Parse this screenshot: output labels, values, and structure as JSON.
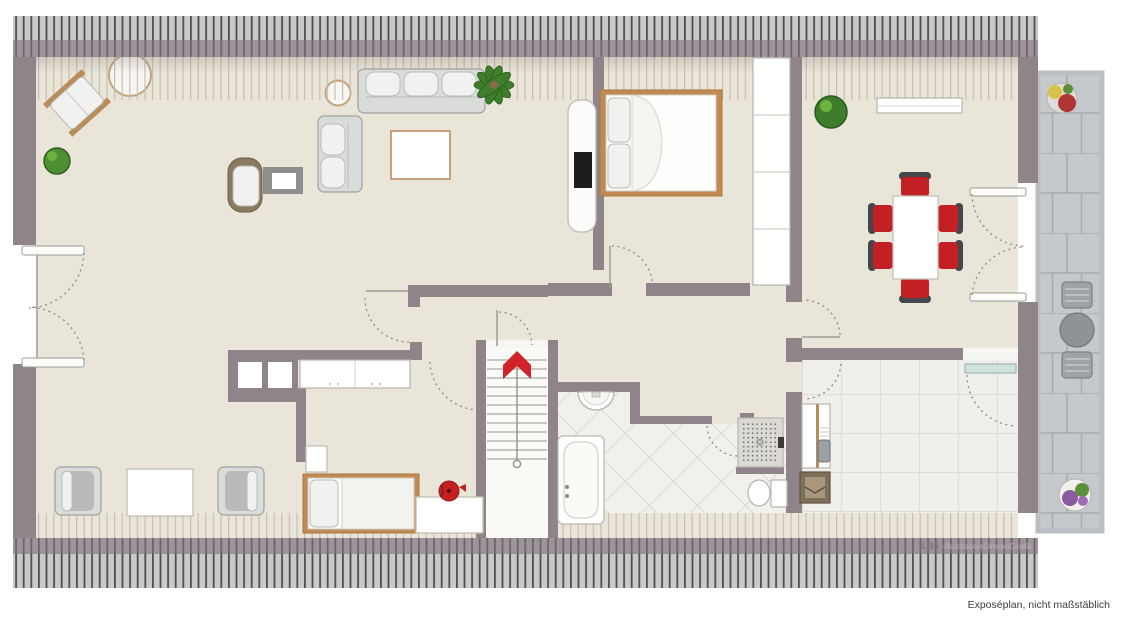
{
  "captions": {
    "watermark_brand": "LBS",
    "watermark_suffix": "-Illustration©immoGrafik",
    "disclaimer": "Exposéplan, nicht maßstäblich"
  },
  "palette": {
    "wall": "#8e848a",
    "floor": "#eae5d9",
    "roof_hatch_bg": "#c9c9c9",
    "roof_hatch_line": "#4e4e4e",
    "bath_tile": "#f1f0ea",
    "kitchen_tile": "#efeeea",
    "terrace_stone": "#c6c9cc",
    "accent_red": "#d2232a",
    "wood": "#c08a52",
    "glass_door": "#cfe2de"
  },
  "plan": {
    "type": "attic-apartment floor plan, top view, not to scale",
    "rooms": [
      {
        "name": "living-room",
        "floor": "beige carpet",
        "furniture": [
          "rotated lounge chair",
          "round side table large",
          "round side table small",
          "three-seat sofa",
          "two-seat sofa",
          "coffee table",
          "wicker armchair",
          "square side table",
          "tv-board with tv",
          "potted plant",
          "palm plant",
          "chimney block with two flues",
          "sideboard",
          "two armchairs with table"
        ]
      },
      {
        "name": "small-bedroom",
        "floor": "beige carpet",
        "furniture": [
          "single bed",
          "nightstand",
          "desk",
          "red kettle"
        ]
      },
      {
        "name": "bedroom",
        "floor": "beige carpet",
        "furniture": [
          "double bed",
          "built-in wardrobe"
        ]
      },
      {
        "name": "hallway",
        "floor": "beige carpet",
        "furniture": [
          "staircase",
          "red up-direction arrow"
        ]
      },
      {
        "name": "bathroom",
        "floor": "diagonal tiles",
        "furniture": [
          "bathtub",
          "washbasin",
          "shower",
          "toilet"
        ]
      },
      {
        "name": "kitchen",
        "floor": "square tiles",
        "furniture": [
          "counter with sink",
          "stove",
          "glass terrace door"
        ]
      },
      {
        "name": "dining-room",
        "floor": "beige carpet",
        "furniture": [
          "dining table",
          "six red chairs",
          "sideboard",
          "potted plant",
          "french doors"
        ]
      },
      {
        "name": "terrace",
        "floor": "stone slabs",
        "furniture": [
          "flower pot red-yellow",
          "two garden chairs",
          "round garden table",
          "flower pot purple"
        ]
      }
    ],
    "features": [
      "sloped-roof hatch band top",
      "sloped-roof hatch band bottom",
      "french doors on left gable wall",
      "dashed door swing arcs"
    ]
  }
}
